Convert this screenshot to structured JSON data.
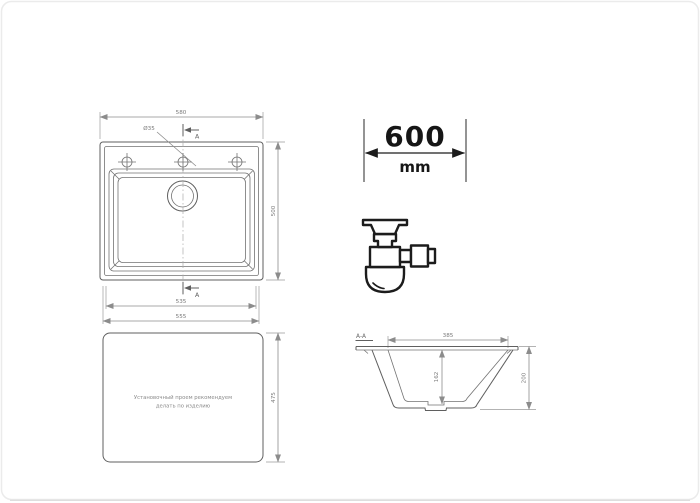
{
  "colors": {
    "drawing_line": "#5f5f5f",
    "dimension_line": "#8c8c8c",
    "dimension_text": "#7a7a7a",
    "bold_text": "#161616",
    "icon_line": "#1c1c1c",
    "frame": "#ebebeb"
  },
  "top_view": {
    "width_label": "580",
    "height_label": "500",
    "hole_diameter_label": "Ø35",
    "section_marker_top": "A",
    "section_marker_bottom": "A",
    "inner_bottom_width_label": "535",
    "outer_bottom_width_label": "555"
  },
  "cabinet_dimension": {
    "value": "600",
    "unit": "mm"
  },
  "icons": {
    "siphon": "siphon-trap-icon"
  },
  "bottom_view": {
    "note_line1": "Установочный проем рекомендуем",
    "note_line2": "делать по изделию",
    "height_label": "475"
  },
  "section_view": {
    "title": "А-А",
    "top_width_label": "385",
    "bowl_depth_label": "162",
    "overall_height_label": "200"
  }
}
